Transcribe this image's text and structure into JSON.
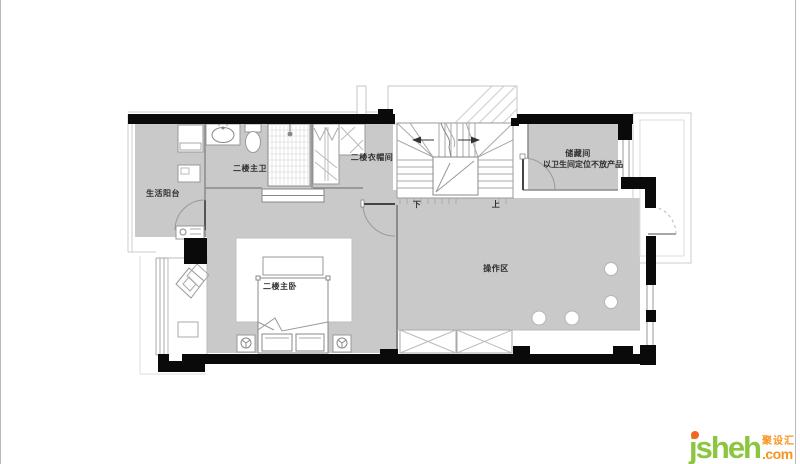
{
  "floorplan": {
    "labels": {
      "balcony": "生活阳台",
      "master_bath": "二楼主卫",
      "cloakroom": "二楼衣帽间",
      "storage_title": "储藏间",
      "storage_note": "以卫生间定位不放产品",
      "operation_area": "操作区",
      "master_bedroom": "二楼主卧",
      "stair_down": "下",
      "stair_up": "上"
    },
    "colors": {
      "floor_fill": "#c9c9c9",
      "wall": "#0a0a0a",
      "thin_line": "#999999"
    }
  },
  "branding": {
    "logo_main": "jsheh",
    "logo_suffix": ".com",
    "logo_cn": "聚设汇",
    "logo_green": "#8cc63e",
    "logo_orange": "#f7941d",
    "logo_dot": "#f26522"
  }
}
